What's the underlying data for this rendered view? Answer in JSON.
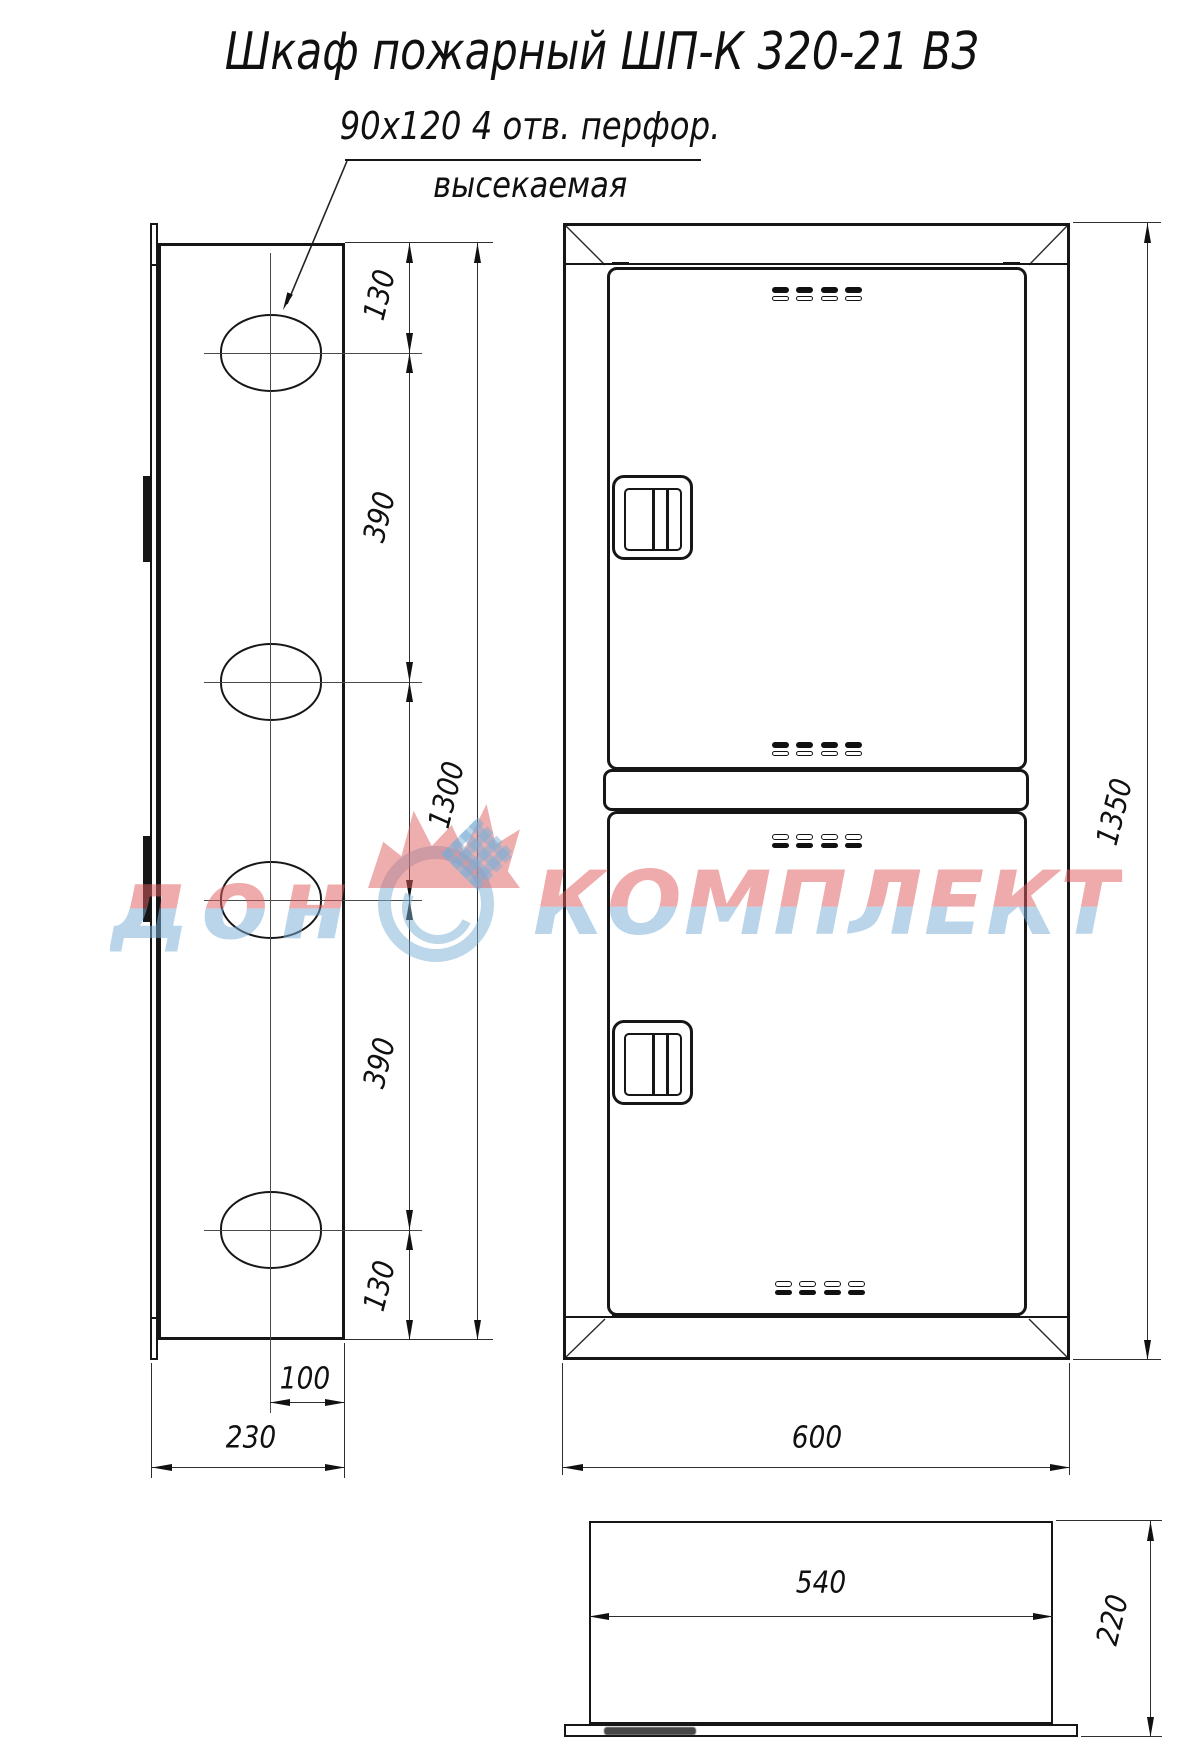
{
  "title": "Шкаф пожарный ШП-К 320-21 ВЗ",
  "note": {
    "size_text": "90х120  4 отв. перфор.",
    "type_text": "высекаемая"
  },
  "watermark": {
    "word1": "дон",
    "word2": "КОМПЛЕКТ",
    "red": "#e05d5d",
    "blue": "#7aadd6"
  },
  "colors": {
    "line": "#161616",
    "background": "#ffffff"
  },
  "side_view": {
    "dims": {
      "top_offset": "130",
      "upper_pitch": "390",
      "hole_span": "1300",
      "lower_pitch": "390",
      "bottom_offset": "130",
      "hole_center_offset": "100",
      "depth": "230"
    }
  },
  "front_view": {
    "dims": {
      "width": "600",
      "height": "1350"
    }
  },
  "top_view": {
    "dims": {
      "inner_width": "540",
      "depth": "220"
    }
  }
}
